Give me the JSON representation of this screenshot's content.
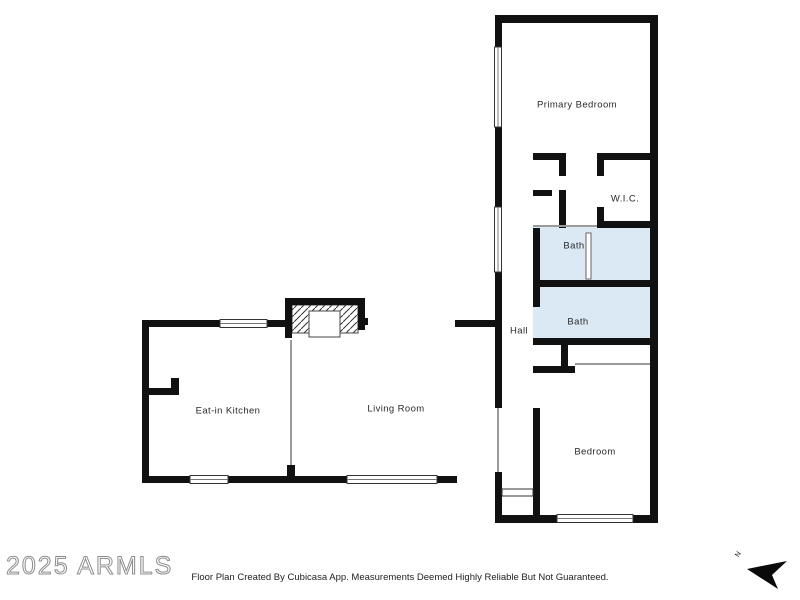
{
  "plan": {
    "rooms": [
      {
        "name": "primary-bedroom",
        "label": "Primary Bedroom"
      },
      {
        "name": "wic",
        "label": "W.I.C."
      },
      {
        "name": "bath-upper",
        "label": "Bath"
      },
      {
        "name": "bath-lower",
        "label": "Bath"
      },
      {
        "name": "hall",
        "label": "Hall"
      },
      {
        "name": "bedroom",
        "label": "Bedroom"
      },
      {
        "name": "eat-in-kitchen",
        "label": "Eat-in Kitchen"
      },
      {
        "name": "living-room",
        "label": "Living Room"
      }
    ]
  },
  "watermark": {
    "text": "2025 ARMLS"
  },
  "footer": {
    "text": "Floor Plan Created By Cubicasa App. Measurements Deemed Highly Reliable But Not Guaranteed."
  },
  "compass": {
    "label": "N"
  },
  "colors": {
    "wall": "#111111",
    "bath_fill": "#dbe9f5",
    "thin_line": "#9a9a9a",
    "watermark_outline": "#8d8d8d",
    "label_text": "#2a2a2a"
  }
}
